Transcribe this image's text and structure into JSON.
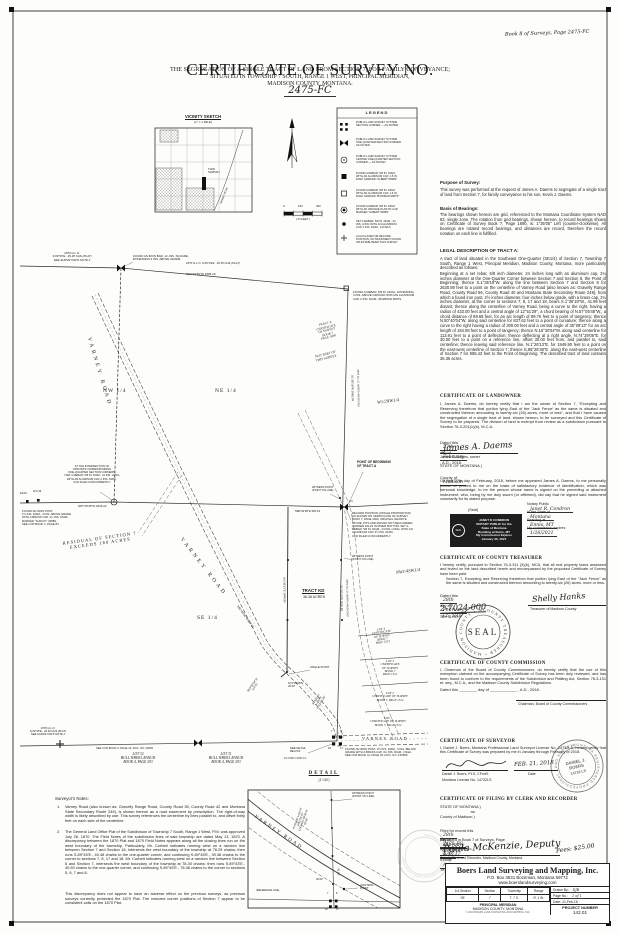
{
  "header": {
    "corner_note": "Book 8 of Surveys, Page 2475-FC",
    "title": "CERTIFICATE OF SURVEY NO.",
    "number": "2475-FC",
    "sub1": "THE SEGREGATION OF A SINGLE TRACT OF LAND FROM SECTION 7,  FOR FAMILY CONVEYANCE;",
    "sub2": "SITUATED IN TOWNSHIP 7 SOUTH, RANGE 1 WEST, PRINCIPAL MERIDIAN,",
    "sub3": "MADISON COUNTY, MONTANA."
  },
  "vicinity": {
    "title": "VICINITY SKETCH",
    "scale": "(1\" = 1 MILE)",
    "this_survey": "THIS\nSURVEY",
    "road": "VARNEY ROAD"
  },
  "scalebar": {
    "zero": "0",
    "mid": "150",
    "full": "300",
    "unit": "( IN FEET )"
  },
  "legend": {
    "title": "LEGEND",
    "items": [
      {
        "text": "PUBLIC LAND SURVEY SYSTEM\nSECTION CORNER — AS NOTED."
      },
      {
        "text": "PUBLIC LAND SURVEY SYSTEM\nONE-QUARTER SECTION CORNER\nAS NOTED."
      },
      {
        "text": "PUBLIC LAND SURVEY SYSTEM\nCENTER ONE-QUARTER SECTION\nCORNER — AS NOTED."
      },
      {
        "text": "FOUND A REBAR, 5/8 IN. DIAM.\nWITH AN ALUMINUM CAP, 1.5 IN.\nDIAM. MARKED \"ALBERT 5098S\""
      },
      {
        "text": "FOUND A REBAR, 5/8 IN. DIAM.\nWITH AN ALUMINUM CAP, 1.5 IN.\nDIAM. MARKED \"BOWMAN 9087S\""
      },
      {
        "text": "FOUND A REBAR, 5/8 IN. DIAM.\nWITH AN ORANGE PLASTIC CAP,\nMARKED \"ALBERT 5098S\""
      },
      {
        "text": "SET A REBAR, 5/8 IN. DIAM., 24\nINS. LONG WITH AN ALUMINUM\nCAP, 2 INS. DIAM., 14732LS"
      },
      {
        "text": "CALCULATED OR RECORD\nPOSITION, NO MONUMENT FOUND\nOR ESTABLISHED THIS SURVEY"
      }
    ]
  },
  "map": {
    "glo_nw": "1870 G.L.O.\nS.89°45'E., 39.38 CHS (PLAT)\nSEE SURVEYOR'S NOTE 2",
    "found_iron_bar": "FOUND AN IRON BAR, 1¼ INS. SQUARE,\nEXTENDING 9 INS. ABOVE GRADE",
    "glo_ne": "1870 G.L.O.  S.89°43'E., 40.50 CHS (PLAT)",
    "brg_north": "N87°19'59\"W  1995.20",
    "found_rebar_ne": "FOUND A REBAR, 5/8 IN. DIAM., EXTENDING\n3 INS. ABOVE GROUND WITH AN ALUMINUM\nCAP, 2 INS. DIAM., BOWMAN 9087S.",
    "nw4": "NW 1/4",
    "ne4": "NE 1/4",
    "se4": "SE 1/4",
    "w2nw4": "W1/2NW1/4",
    "nw4sw4": "NW1/4SW1/4",
    "e2ne4": "E1/2NE1/4NE1/4",
    "varney": "VARNEY ROAD",
    "tract_a": "TRACT A\nCERTIFICATE\nOF SURVEY\nBOOK 7\nPAGE 1690",
    "not_part": "NOT PART OF\nTHIS SURVEY",
    "residual": "RESIDUAL OF SECTION 7\nEXCEEDS 160 ACRES",
    "sec_line_u": "S1°36'19\"W  2662.09",
    "glo_chs": "1870 G.L.O. NORTH 40.00 CHS",
    "sec_line_l": "S1°36'19\"W  2630.89",
    "tract_line": "N1°26'13\"E  1949.90",
    "quarter_label": "1/4",
    "c4_note": "AT THE INTERSECTION OF\nOPPOSITE CORRESPONDING\nONE-QUARTER SECTION CORNERS,\nI SET A REBAR, 5/8 IN. DIAM., 24 INS. LONG,\nWITH AN ALUMINUM CAP, 2 INS. DIAM.,\nCCR FILED CONCURRENTLY.",
    "ew_brg": "N87°25'35\"W  2646.22",
    "ew_brg_e": "S88°26'38\"E  955.43",
    "sixteenth_e": "E1/16",
    "sixteenth_w": "W 1/16",
    "found_iron_post_w": "FOUND AN IRON POST,\n1½ INS. DIAM., 3 INS. ABOVE GRADE\nWITH A BRASS CAP, 1¾ INS. DIAM.,\nMARKED \"SUFICO\" 3488S,\nSEE CCR BOOK 1, PAGE 84",
    "pob_title": "POINT OF BEGINNING\nOF TRACT A",
    "pob_note": "RECORD POSITION (SINGLE PROPORTION)\nAS SHOWN ON CERTIFICATE OF SURVEY\nBOOK 7, PAGE 1690. ORIGINAL GRANITE\nSTONE, PITS AND MOUND NOT RECOVERED,\nCORNER FALLS IN RIVER BOTTOM.  SET A\nREBAR, 5/8 IN. DIAM., 24 INS. LONG, WITH AN\nALUMINUM CAP, 2½ INS. DIAM.,\nCCR FILED CONCURRENTLY.",
    "witness": "WITNESS POINT\n(POINT ON LINE)",
    "tract_kd": "TRACT KD",
    "tract_kd_area": "36.36 ACRES",
    "angle_point": "ANGLE POINT",
    "brg_tie": "N74°29'06\"E\n30.00'",
    "brg_road1": "N15°30'54\"W\n113.91'",
    "curve_road": "R=433.00'\nL=89.76'\nΔ=12°51'29\"",
    "brg_road2": "N50°40'04\"W  837.62",
    "glo_sw": "1870 G.L.O.\nS.89°45'E., 40.48 CHS (PLAT)\nSEE SURVEYOR'S NOTE 2",
    "lot32": "LOT 32\nBULL WHEEL RANCH\nBOOK 4, PAGE 293",
    "lot31": "LOT 31\nBULL WHEEL RANCH\nBOOK 4, PAGE 293",
    "ccr_sw": "SEE CCR BOOK 6, PAGE 19, DOC. NO. 06000",
    "found_post_se": "FOUND AN IRON POST, 2½ INS. DIAM., 4 INS. BELOW\nGRADE WITH A BRASS CAP, 3¼ INS. DIAM., CS&A,\nSEE CCR BOOK 11, PAGE 33, DOC. NO. 150568",
    "see_detail": "SEE DETAIL\nBELOW",
    "cross7": "7",
    "cross8": "8",
    "cross18": "18",
    "cross17": "17",
    "lot4": "LOT 4\nCERTIFICATE\nOF SURVEY\nBOOK 7\nPAGE 1512",
    "lot3": "LOT 3\nCERTIFICATE\nOF SURVEY\nBOOK 7\nPAGE 1512",
    "lot2": "LOT 2\nCERTIFICATE OF SURVEY\nBOOK 7, PAGE 1512",
    "lot1": "LOT 1\nCERTIFICATE OF SURVEY\nBOOK 7, PAGE 1512"
  },
  "notes": {
    "title": "Surveyor's Notes:",
    "n1": "1.",
    "t1": "Varney Road (also known as: Gravelly Range Road, County Road 35, County Road 42 and Montana State Secondary Route 249), is shown hereon as a road easement by prescription.  The right-of-way width is likely described by use.  This survey references the centerline by lines parallel to, and offset thirty feet on each side of the centerline.",
    "n2": "2.",
    "t2": "The General Land Office Plat of the Subdivision of Township 7 South, Range 1 West, P.M. was approved July 26, 1870.  The Field Notes of the subdivision lines of said township are dated May 13, 1870.  A discrepancy between the 1870 Plat and 1870 Field Notes appears along all the closing lines run on the west boundary of the township.  Particularly, Mr. Corbett indicates running west on a random line between Section 7 and Section 18, intersects the west boundary of the township at 78.29 chains; then runs S.89°45'E., 40.48 chains to the one-quarter corner, and continuing S.89°45'E., 39.38 chains to the corner to sections 7, 8, 17 and 18.  Mr. Corbett indicates running west on a random line between Section 6 and Section 7, intersects the west boundary of the township at 78.30 chains; then runs S.89°43'E., 40.50 chains to the one-quarter corner, and continuing S.89°45'E., 78.38 chains to the corner to sections 5, 6, 7 and 8.",
    "closing": "This discrepancy does not appear to have an adverse effect on the previous surveys, as previous surveys correctly protected the 1870 Plat.  The restored corner positions of Section 7 appear to be consistent calls on the 1870 Plat."
  },
  "detail": {
    "label": "DETAIL",
    "scale": "(1\"=30')",
    "road": "VARNEY ROAD",
    "witness": "WITNESS POINT\n(POINT ON LINE)",
    "control": "CONTROL\nPOINT",
    "curve": "R=433.00'  L=89.76'\nΔ=12°51'29\"\nCHD=N57°05'48\"W\n89.58'",
    "d1": "41.99'",
    "d2": "30.00'",
    "ref": "(REFERENCE LINE)"
  },
  "purpose": {
    "title": "Purpose of Survey:",
    "body": "This survey was performed at the request of James A. Daems to segregate of a single tract of land from Section 7, for family conveyance to his son, Kevin J. Daems."
  },
  "basis": {
    "title": "Basis of Bearings:",
    "body": "The bearings shown hereon are grid, referenced to the Montana Coordinate System NAD 83, single zone.  The rotation from grid bearings, shown hereon, to record bearings shown on Certificate of Survey Book 7, Page 1690, is: 1°36'05\" Left (counter-clockwise).  All bearings are rotated record bearings, and distances are record, therefore the record notation on each line is fulfilled."
  },
  "legal": {
    "title": "LEGAL DESCRIPTION OF TRACT A:",
    "intro": "A tract of land situated in the Southeast One-Quarter (SE1/4) of Section 7, Township 7 South, Range 1 West, Principal Meridian, Madison County, Montana, more particularly described as follows:",
    "body": "Beginning at a set rebar, 5/8 inch diameter, 24 inches long with an aluminum cap, 2¼ inches diameter at the One-Quarter Corner between Section 7 and Section 8, the Point of Beginning; thence S.1°36'19\"W. along the line between Section 7 and Section 8 for 2630.89 feet to a point on the centerline of Varney Road (also known as: Gravelly Range Road, County Road 56, County Road 40 and Montana State Secondary Route 249), from which a found iron post, 2½ inches diameter, four inches below grade, with a brass cap, 3¼ inches diameter, at the corner to sections 7, 8, 17 and 18, bears S.1°36'19\"W., 41.99 feet distant; thence along the centerline of Varney Road, being a curve to the right, having a radius of 433.00 feet and a central angle of 12°51'29\", a chord bearing of N.57°05'48\"W., a chord distance of 89.58 feet, for an arc length of 89.76 feet to a point of tangency; thence N.50°40'04\"W. along said centerline for 837.62 feet to a point of curvature; thence along a curve to the right having a radius of 300.00 feet and a central angle of 35°09'13\" for an arc length of 184.08 feet to a point of tangency; thence N.15°30'54\"W. along said centerline for 113.91 feet to a point of deflection; thence deflecting at a right angle, N.74°29'06\"E. for 30.00 feet to a point on a reference line, offset 30.00 feet from, and parallel to, said centerline; thence leaving said reference line, N.1°26'13\"E. for 1949.90 feet to a point on the east-west centerline of Section 7; thence S.88°26'38\"E. along the east-west centerline of Section 7 for 955.43 feet to the Point of Beginning.  The described tract of land contains 36.36 acres."
  },
  "landowner": {
    "title": "CERTIFICATE OF LANDOWNER",
    "body": "I, James A. Daems, do hereby certify that I am the owner of Section 7, \"Excepting and Reserving therefrom that portion lying East of the 'Jack Fence' as the same is situated and constructed thereon amounting to twenty-six (26) acres, more or less\", and that I have caused the segregation of a single tract of land, shown hereon, to be surveyed and this Certificate of Survey to be prepared.  The division of land is exempt from review as a subdivision pursuant to Section 76-3-201(1)(b), M.C.A.",
    "dated": {
      "pre": "Dated this",
      "day": "27th",
      "mid": "day of",
      "month": "February",
      "post": ", A.D., 2018."
    },
    "signature": "James A. Daems",
    "sig_label": "James A. Daems, owner",
    "state": "STATE OF MONTANA               )",
    "county_pre": "County of",
    "county_hw": "Madison",
    "county_post": ")",
    "notary_para": "On this 27th day of February, 2018, before me appeared James A. Daems, to me personally known or proved to me on the basis of satisfactory evidence of identification, which was personal knowledge, to be the person whose name is signed on the preceding or attached instrument, who, being by me duly sworn (or affirmed), did say that he signed said instrument voluntarily for its stated purpose.",
    "seal_label": "(Seal)",
    "stamp_seal": "SEAL",
    "stamp_lines": "JANET R CONDRON\nNOTARY PUBLIC for the\nState of Montana\nResiding at Ennis, MT\nMy Commission Expires\nJanuary 26, 2021",
    "notary": {
      "label1": "Notary Public",
      "value1": "Janet R. Condron",
      "label2": "In the State of",
      "value2": "Montana",
      "label3": "Residing at",
      "value3": "Ennis, MT",
      "label4": "My commission expires",
      "value4": "1/26/2021"
    }
  },
  "treasurer": {
    "title": "CERTIFICATE OF COUNTY TREASURER",
    "body1": "I hereby certify, pursuant to Section 76-3-311 (3)(b), MCA, that all real property taxes assessed and levied on the land described herein and encompassed by the proposed Certificate of Survey have been paid.",
    "body2": "Section 7, Excepting and Reserving therefrom that portion lying East of the \"Jack Fence\" as the same is situated and constructed thereon amounting to twenty-six (26) acres, more or less.",
    "dated": {
      "pre": "Dated this",
      "day": "28th",
      "mid": "day of",
      "month": "February",
      "post": ", A.D., 2018."
    },
    "signature": "Shelly Hanks",
    "sig_label": "Treasurer of Madison County",
    "tax_id": "2-7024-000",
    "tax_label": "TAX ID NO.",
    "seal_ring": "COUNTY TREASURER • MADISON COUNTY • MONTANA •",
    "seal_center": "SEAL"
  },
  "commission": {
    "title": "CERTIFICATE OF COUNTY COMMISSION",
    "body": "I, Chairman of the Board of County Commissioners, do hereby certify that the use of this exemption claimed on the accompanying Certificate of Survey has been duly reviewed, and has been found to conform to the requirements of the Subdivision and Platting Act, Section 76-3-101 et. seq., M.C.A., and the Madison County Subdivision Regulations.",
    "dated": "Dated this ________ day of ____________ , A.D., 2018.",
    "sig_label": "Chairman, Board of County Commissioners"
  },
  "surveyor": {
    "title": "CERTIFICATE OF SURVEYOR",
    "body": "I, Daniel J. Boers, Montana Professional Land Surveyor License No. 14732LS, hereby certify that this Certificate of Survey was prepared by me in January through February of 2018.",
    "date_hw": "FEB. 21, 2018",
    "sig_label": "Daniel J. Boers, PLS, CFedS",
    "date_label": "Date",
    "license": "Montana License No. 14732LS",
    "seal_ring": "MONTANA REGISTERED PROFESSIONAL LAND SURVEYOR • ",
    "seal_name": "DANIEL J.\nBOERS",
    "seal_no": "14732 LS"
  },
  "filing": {
    "title": "CERTIFICATE OF FILING BY CLERK AND RECORDER",
    "state": "STATE OF MONTANA     )",
    "ss": ":ss",
    "county": "County of Madison       )",
    "filed": {
      "pre": "Filed for record this",
      "day": "28th",
      "m1": "day of",
      "month": "February",
      "m2": ", 2018, at",
      "time": "9:15",
      "m3": "o'clock",
      "ampm": "A",
      "m4": ".M."
    },
    "recorded": {
      "pre": "Recorded in Book 7 of Surveys, Page",
      "page": "2475-FC",
      "mid": "and Document No.",
      "doc": "176717"
    },
    "signature": "Paula McKenzie, Deputy",
    "sig_label": "County Clerk and Recorder, Madison County, Montana",
    "fees": "Fees: $25.00"
  },
  "titleblock": {
    "company": "Boers Land Surveying and Mapping, Inc.",
    "address": "P.O. Box 3531  Bozeman, Montana  59772",
    "website": "www.boerslandsurveying.com",
    "h1": "1/4-Section",
    "h2": "Section",
    "h3": "Township",
    "h4": "Range",
    "v1": "SE",
    "v2": "7",
    "v3": "T. 7 S.",
    "v4": "R. 1 W.",
    "meridian": "PRINCIPAL MERIDIAN",
    "county": "MADISON COUNTY, MONTANA",
    "drawn_label": "Drawn By:",
    "drawn": "DJB",
    "page_label": "Page No.:",
    "page": "1 of 1",
    "date_label": "Date:",
    "date": "21-Feb-18",
    "project_label": "PROJECT NUMBER",
    "project": "142.01",
    "copyright": "© 2018 BOERS LAND SURVEYING AND MAPPING, INC."
  }
}
